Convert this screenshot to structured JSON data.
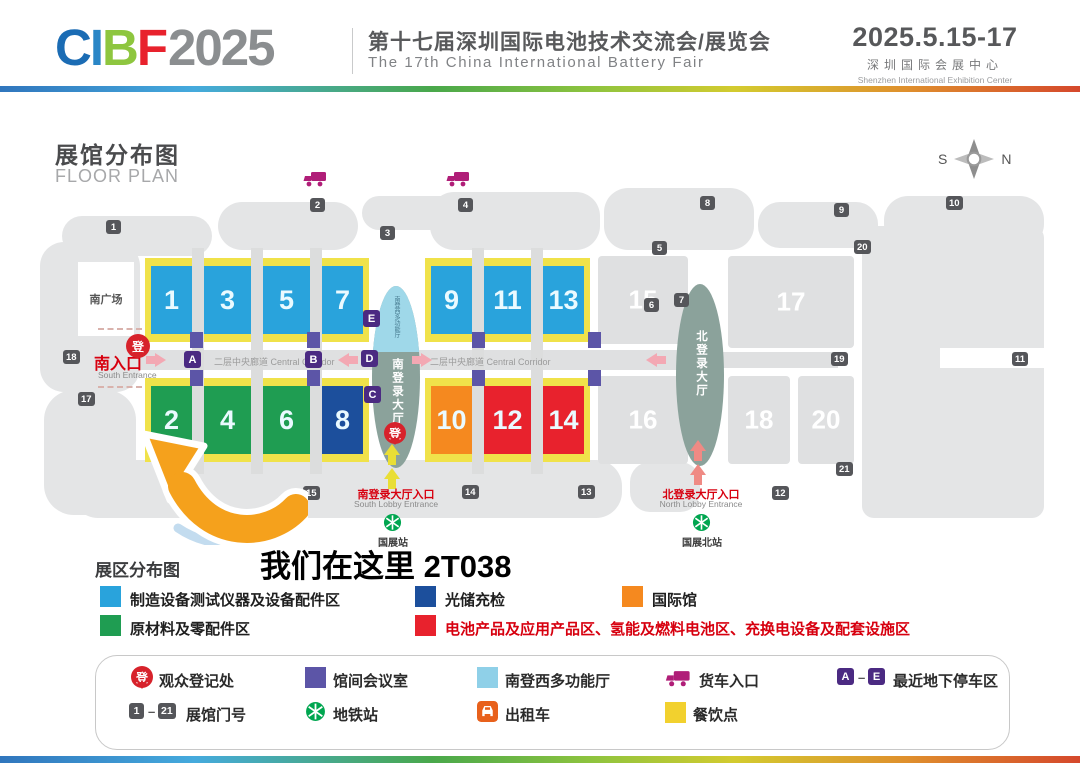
{
  "header": {
    "logo_letters": [
      "C",
      "I",
      "B",
      "F"
    ],
    "logo_year": "2025",
    "title_cn": "第十七届深圳国际电池技术交流会/展览会",
    "title_en": "The 17th China International Battery Fair",
    "date_range": "2025.5.15-17",
    "venue_cn": "深圳国际会展中心",
    "venue_en": "Shenzhen International Exhibition Center"
  },
  "map": {
    "title_cn": "展馆分布图",
    "title_en": "FLOOR PLAN",
    "compass_s": "S",
    "compass_n": "N",
    "south_plaza": "南广场",
    "south_entrance_cn": "南入口",
    "south_entrance_en": "South Entrance",
    "corridor_label": "二层中央廊道 Central Corridor",
    "south_lobby": "南登录大厅",
    "south_multi_hall": "南登西多功能厅",
    "north_lobby": "北登录大厅",
    "south_lobby_entrance_cn": "南登录大厅入口",
    "south_lobby_entrance_en": "South Lobby Entrance",
    "north_lobby_entrance_cn": "北登录大厅入口",
    "north_lobby_entrance_en": "North Lobby Entrance",
    "metro_south_station": "国展站",
    "metro_north_station": "国展北站",
    "registration_glyph": "登",
    "halls_top": [
      "1",
      "3",
      "5",
      "7",
      "9",
      "11",
      "13"
    ],
    "halls_bottom": [
      "2",
      "4",
      "6",
      "8",
      "10",
      "12",
      "14"
    ],
    "gray_halls": [
      "15",
      "16",
      "17",
      "18",
      "20"
    ],
    "gate_badges": [
      "1",
      "2",
      "3",
      "4",
      "5",
      "6",
      "7",
      "8",
      "9",
      "10",
      "11",
      "12",
      "13",
      "14",
      "15",
      "17",
      "18",
      "19",
      "20",
      "21"
    ],
    "parking_badges": [
      "A",
      "B",
      "C",
      "D",
      "E"
    ]
  },
  "callout": {
    "text": "我们在这里 2T038"
  },
  "zone_legend": {
    "title": "展区分布图",
    "items": [
      {
        "color": "#29a3dc",
        "label": "制造设备测试仪器及设备配件区"
      },
      {
        "color": "#1f9d52",
        "label": "原材料及零配件区"
      },
      {
        "color": "#1c4f9c",
        "label": "光储充检"
      },
      {
        "color": "#e8222d",
        "label": "电池产品及应用产品区、氢能及燃料电池区、充换电设备及配套设施区"
      },
      {
        "color": "#f5891f",
        "label": "国际馆"
      }
    ]
  },
  "facility_legend": {
    "registration": "观众登记处",
    "meeting_room": "馆间会议室",
    "multi_hall": "南登西多功能厅",
    "truck_entrance": "货车入口",
    "parking": "最近地下停车区",
    "gate_numbers": "展馆门号",
    "metro": "地铁站",
    "taxi": "出租车",
    "dining": "餐饮点",
    "range_start": "1",
    "range_end": "21",
    "dash": "–",
    "park_start": "A",
    "park_end": "E"
  },
  "colors": {
    "hall_blue": "#29a3dc",
    "hall_green": "#1f9d52",
    "hall_navy": "#1c4f9c",
    "hall_orange": "#f5891f",
    "hall_red": "#e8222d",
    "strip_yellow": "#f0e24a",
    "parking_badge_purple": "#4b2a82",
    "meeting_purple": "#5c55a7",
    "lobby_gray_green": "#8ba29b",
    "multi_hall_lightblue": "#9fd8e9",
    "accent_red": "#d7000f",
    "truck_magenta": "#b01e78",
    "metro_green": "#00a650",
    "taxi_orange": "#e8611c",
    "dining_yellow": "#f2d12e",
    "callout_arrow_orange": "#f5a11c"
  }
}
